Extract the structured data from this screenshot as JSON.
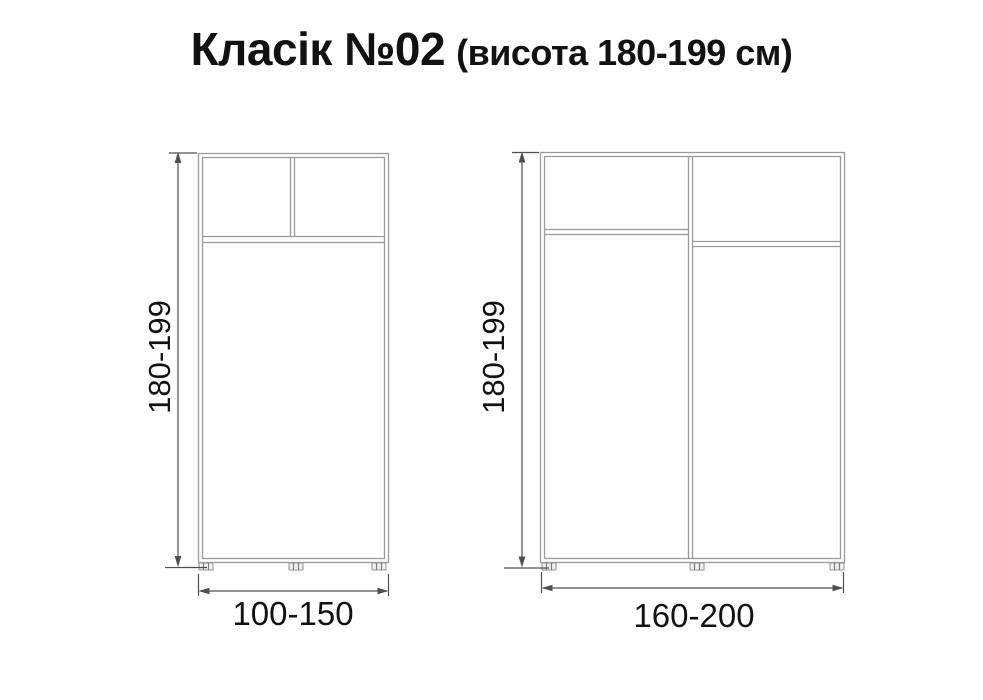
{
  "title": {
    "main": "Класік №02",
    "suffix": "(висота 180-199 см)"
  },
  "diagrams": [
    {
      "id": "wardrobe-small",
      "description": "two-compartment wardrobe schematic, front view",
      "height_label": "180-199",
      "width_label": "100-150"
    },
    {
      "id": "wardrobe-large",
      "description": "two-section wardrobe schematic with offset shelves, front view",
      "height_label": "180-199",
      "width_label": "160-200"
    }
  ],
  "colors": {
    "background": "#ffffff",
    "furniture_line": "#9a9a9a",
    "dimension_line": "#4f4f4f",
    "text": "#121212"
  }
}
